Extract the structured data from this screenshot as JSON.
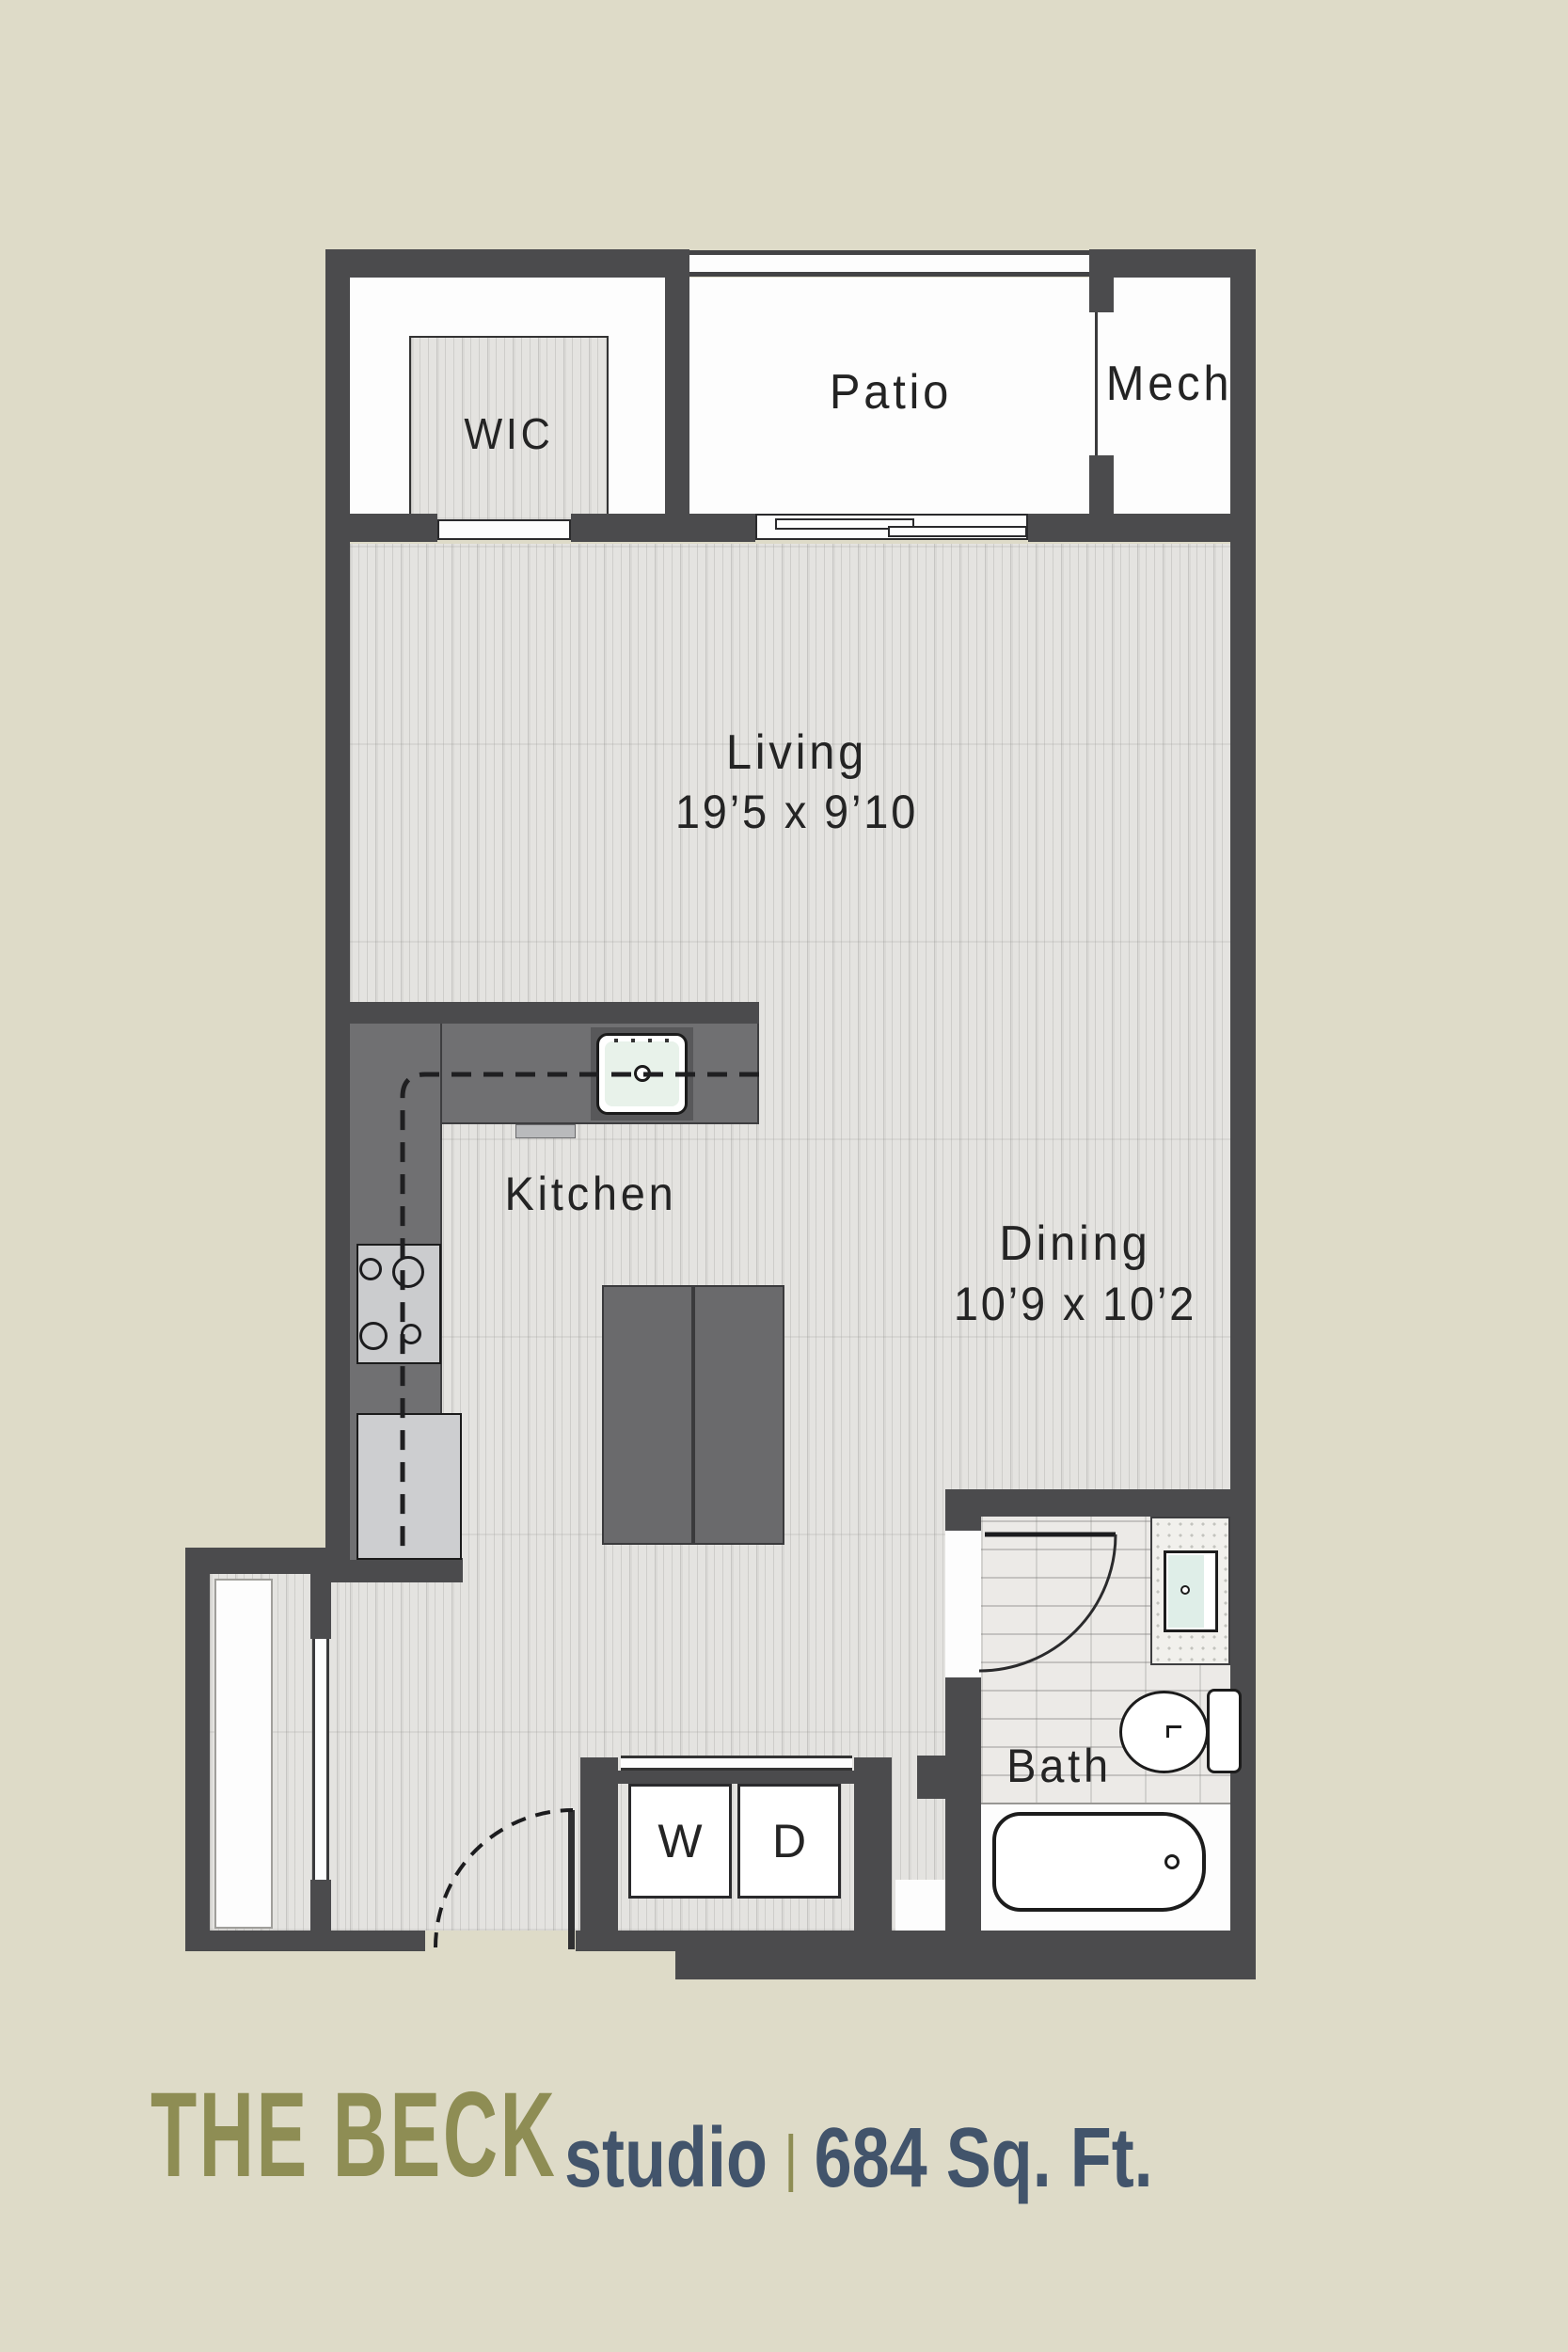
{
  "footer": {
    "name": "THE BECK",
    "unit_type": "studio",
    "area": "684 Sq. Ft."
  },
  "rooms": {
    "wic": "WIC",
    "patio": "Patio",
    "mech": "Mech",
    "living": "Living",
    "living_dims": "19’5 x 9’10",
    "dining": "Dining",
    "dining_dims": "10’9 x 10’2",
    "kitchen": "Kitchen",
    "bath": "Bath"
  },
  "appliances": {
    "washer": "W",
    "dryer": "D"
  },
  "colors": {
    "background": "#dedbc8",
    "wall": "#4b4b4d",
    "wood_floor": "#e4e3e0",
    "tile_floor": "#eceae7",
    "counter": "#707072",
    "island": "#6a6a6c",
    "accent_olive": "#8e8d54",
    "accent_slate": "#42546b"
  }
}
